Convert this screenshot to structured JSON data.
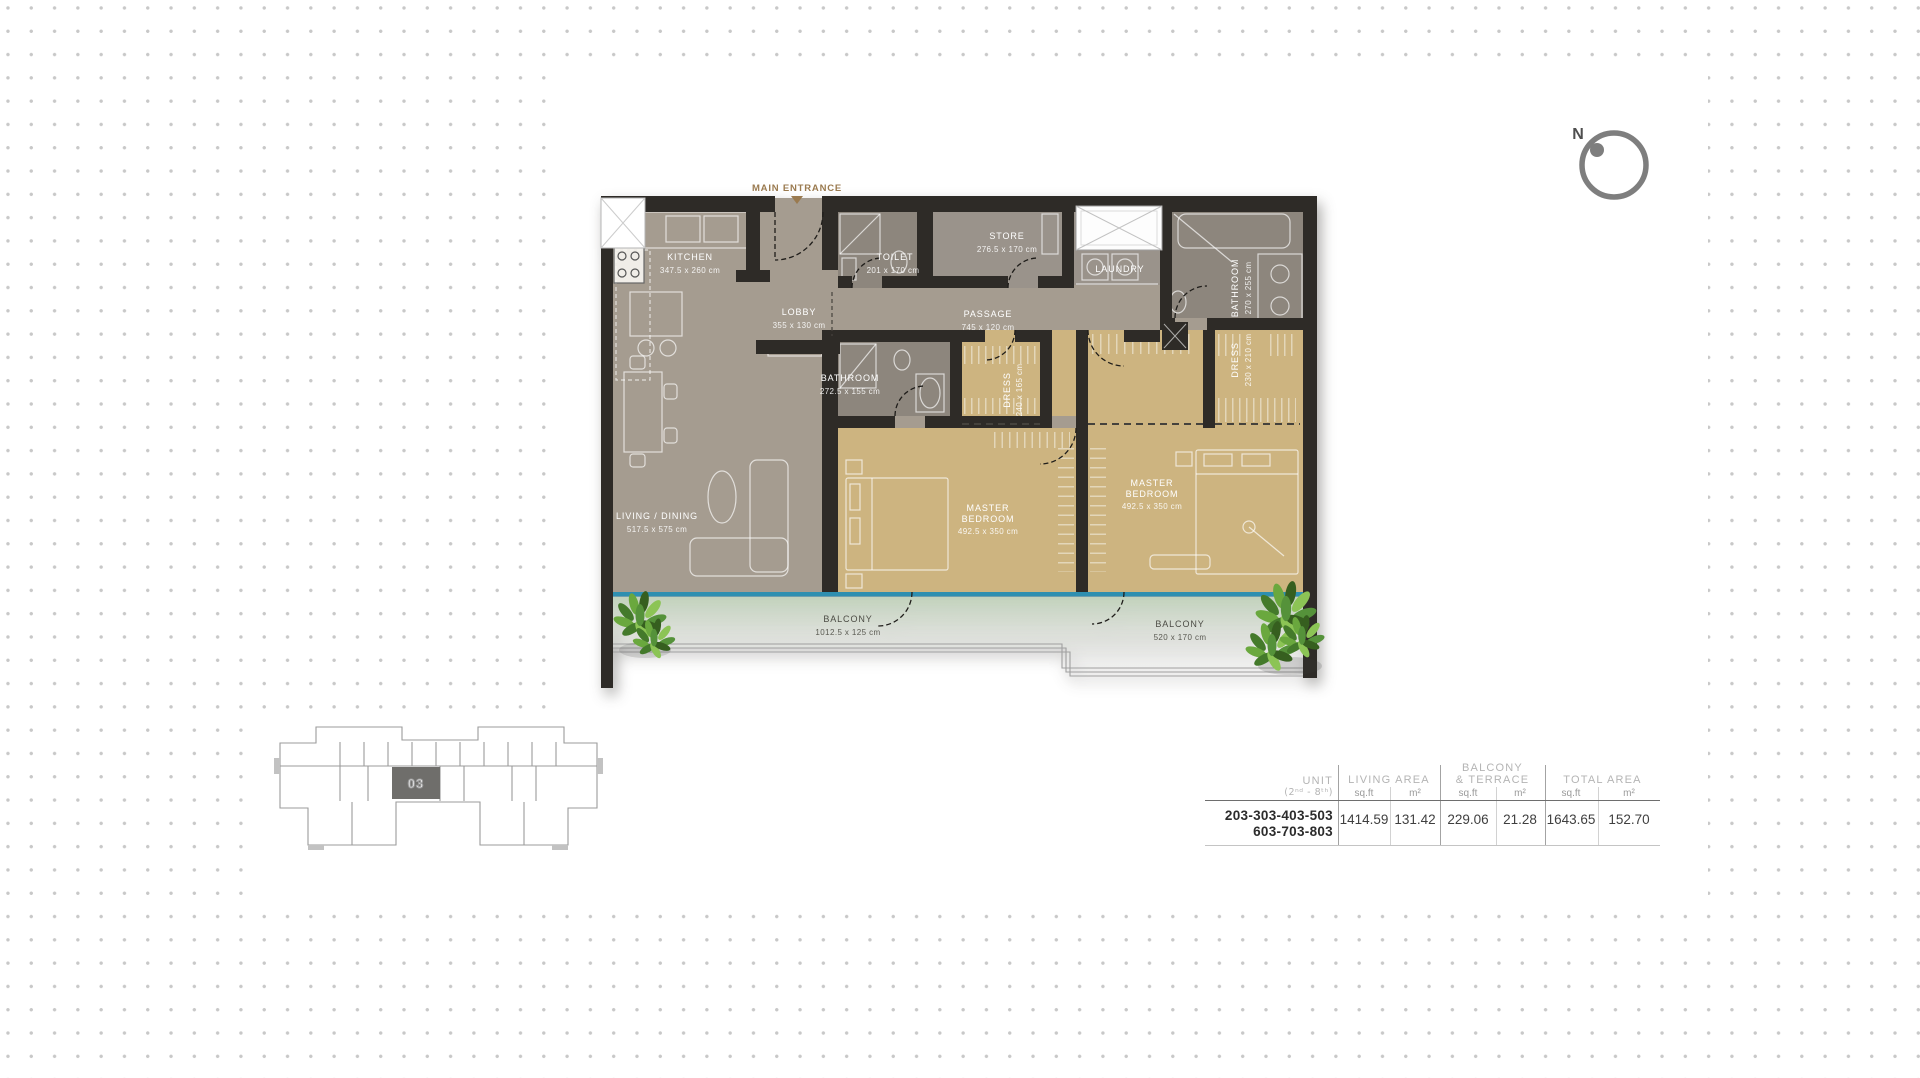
{
  "compass": {
    "north_label": "N"
  },
  "floor_plan": {
    "entrance": {
      "label": "MAIN ENTRANCE"
    },
    "rooms": {
      "kitchen": {
        "name": "KITCHEN",
        "dims": "347.5 x 260 cm"
      },
      "toilet": {
        "name": "TOILET",
        "dims": "201 x 170 cm"
      },
      "store": {
        "name": "STORE",
        "dims": "276.5 x 170 cm"
      },
      "laundry": {
        "name": "LAUNDRY"
      },
      "lobby": {
        "name": "LOBBY",
        "dims": "355 x 130 cm"
      },
      "passage": {
        "name": "PASSAGE",
        "dims": "745 x 120 cm"
      },
      "bathroom_mid": {
        "name": "BATHROOM",
        "dims": "272.5 x 155 cm"
      },
      "dress_mid": {
        "name": "DRESS",
        "dims": "240 x 165 cm"
      },
      "bathroom_right": {
        "name": "BATHROOM",
        "dims": "270 x 255 cm"
      },
      "dress_right": {
        "name": "DRESS",
        "dims": "230 x 210 cm"
      },
      "master_bedroom_left": {
        "line1": "MASTER",
        "line2": "BEDROOM",
        "dims": "492.5 x 350 cm"
      },
      "master_bedroom_right": {
        "line1": "MASTER",
        "line2": "BEDROOM",
        "dims": "492.5 x 350 cm"
      },
      "living_dining": {
        "name": "LIVING / DINING",
        "dims": "517.5 x 575 cm"
      },
      "balcony_left": {
        "name": "BALCONY",
        "dims": "1012.5 x 125 cm"
      },
      "balcony_right": {
        "name": "BALCONY",
        "dims": "520 x 170 cm"
      }
    }
  },
  "key_plan": {
    "unit_label": "03"
  },
  "area_table": {
    "unit_header": "UNIT",
    "unit_subheader": "(2ⁿᵈ - 8ᵗʰ)",
    "sqft_label": "sq.ft",
    "m2_label": "m²",
    "groups": [
      {
        "line1": "LIVING AREA",
        "line2": "",
        "sqft": "1414.59",
        "m2": "131.42"
      },
      {
        "line1": "BALCONY",
        "line2": "& TERRACE",
        "sqft": "229.06",
        "m2": "21.28"
      },
      {
        "line1": "TOTAL AREA",
        "line2": "",
        "sqft": "1643.65",
        "m2": "152.70"
      }
    ],
    "unit_numbers": {
      "line1": "203-303-403-503",
      "line2": "603-703-803"
    }
  },
  "colors": {
    "wall": "#2e2b27",
    "floor_living": "#a59c90",
    "floor_bedroom": "#cdb480",
    "floor_service": "#8d867d",
    "floor_store": "#9a938b",
    "glazing_line": "#2e8fb0",
    "entrance_accent": "#9a7a4f",
    "plant_green": "#6aa83e",
    "dot_grid": "#c8c8c8"
  }
}
